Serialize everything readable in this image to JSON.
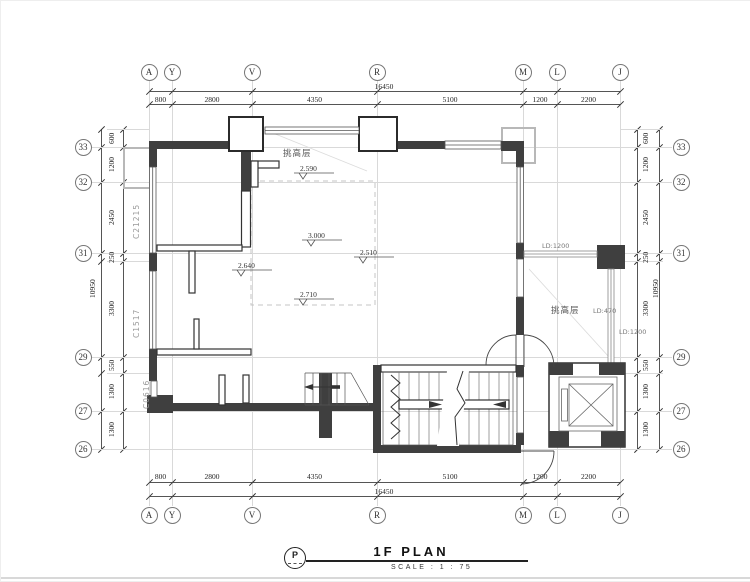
{
  "grid": {
    "cols": {
      "labels": [
        "A",
        "Y",
        "V",
        "R",
        "M",
        "L",
        "J"
      ],
      "segments": [
        "800",
        "2800",
        "4350",
        "5100",
        "1200",
        "2200"
      ],
      "total": "16450"
    },
    "rows": {
      "labels": [
        "33",
        "32",
        "31",
        "29",
        "27",
        "26"
      ],
      "segments": [
        "600",
        "1200",
        "2450",
        "250",
        "3300",
        "550",
        "1300",
        "1300"
      ],
      "total": "10950"
    }
  },
  "plan": {
    "area_labels": {
      "top_void": "挑高层",
      "right_void": "挑高层"
    },
    "window_tags": {
      "left_top": "C21215",
      "left_mid": "C1517",
      "left_bottom": "C0616"
    },
    "railing_tags": {
      "top": "LD:1200",
      "right": "LD:470",
      "far_right": "LD:1200"
    },
    "levels": {
      "top": "2.590",
      "center": "3.000",
      "left": "2.640",
      "right": "2.510",
      "bottom": "2.710"
    }
  },
  "title_block": {
    "symbol": "P",
    "title": "1F PLAN",
    "scale": "SCALE :  1 : 75"
  }
}
